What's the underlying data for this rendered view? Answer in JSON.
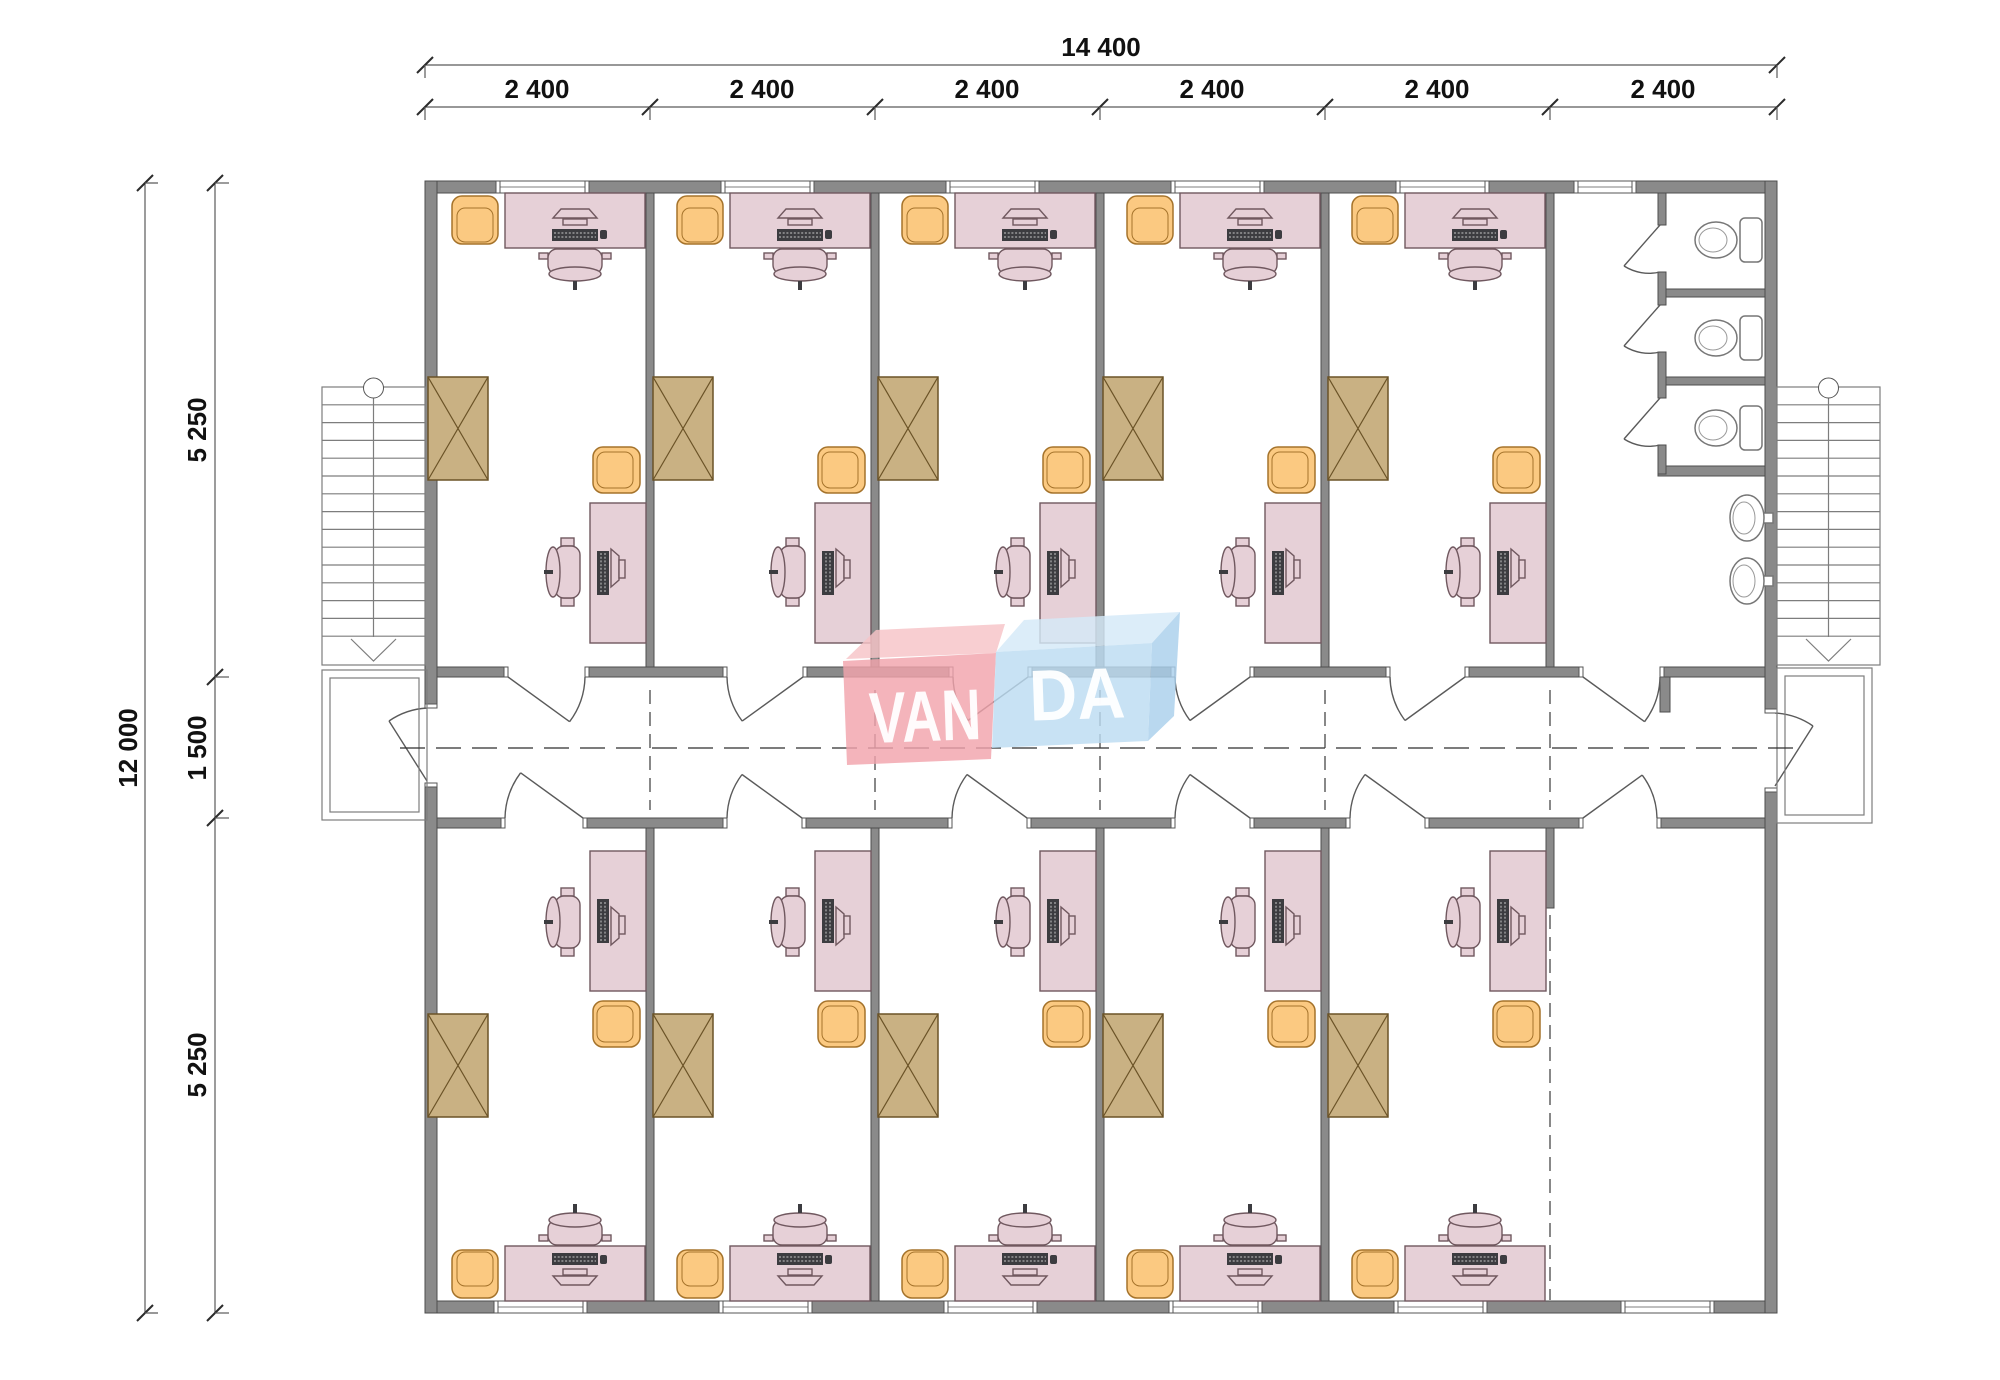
{
  "dimensions": {
    "top": {
      "total": "14 400",
      "segments": [
        "2 400",
        "2 400",
        "2 400",
        "2 400",
        "2 400",
        "2 400"
      ]
    },
    "left": {
      "total": "12 000",
      "segments": [
        "5 250",
        "1 500",
        "5 250"
      ]
    }
  },
  "logo": {
    "part1": "VAN",
    "part2": "DA",
    "part1_bg": "#f2a4ac",
    "part1_top": "#f6c3c7",
    "part2_bg": "#bcdcf2",
    "part2_top": "#d4e9f8",
    "part2_side": "#a9cfec",
    "text_color": "#ffffff"
  },
  "plan": {
    "office_rooms_top": 5,
    "office_rooms_bottom": 5,
    "empty_rooms": 1,
    "toilet_stalls": 3,
    "sinks": 2,
    "staircases": 2,
    "entry_landings": 2,
    "corridors": 1
  },
  "colors": {
    "wall": "#8a8a8a",
    "wall_outline": "#4d4d4d",
    "desk": "#e6d0d7",
    "desk_outline": "#70585f",
    "armchair": "#fbc981",
    "armchair_outline": "#a5732b",
    "cabinet": "#c9b183",
    "cabinet_outline": "#6b5327",
    "fixture_outline": "#777777",
    "dim_text": "#111111"
  }
}
